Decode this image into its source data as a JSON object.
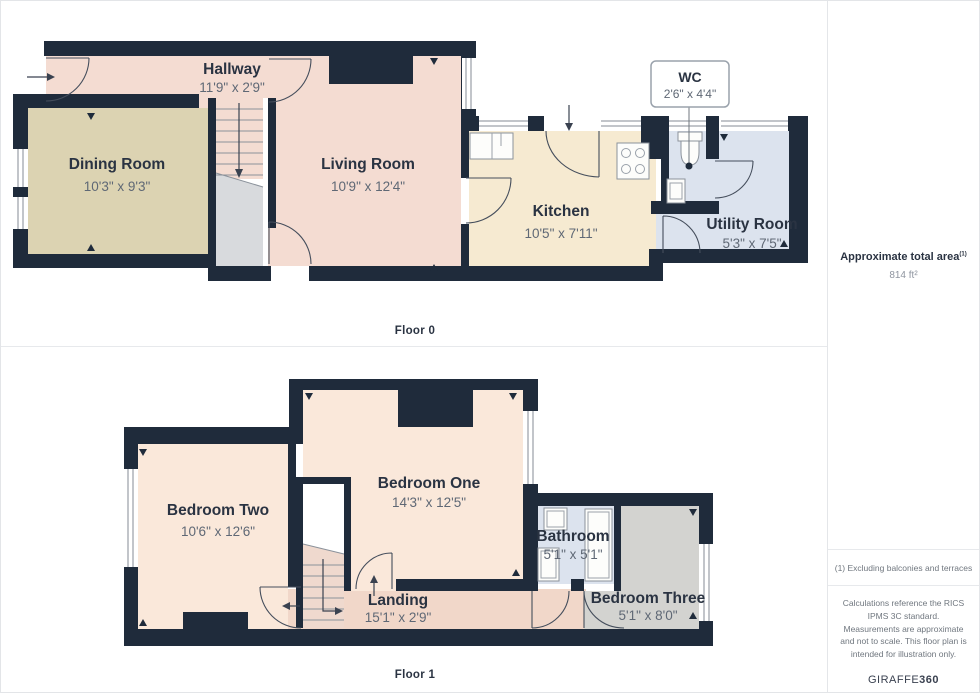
{
  "floors": [
    {
      "label": "Floor 0",
      "rooms": [
        {
          "name": "Hallway",
          "dims": "11'9\" x 2'9\""
        },
        {
          "name": "Dining Room",
          "dims": "10'3\" x 9'3\""
        },
        {
          "name": "Living Room",
          "dims": "10'9\" x 12'4\""
        },
        {
          "name": "Kitchen",
          "dims": "10'5\" x 7'11\""
        },
        {
          "name": "WC",
          "dims": "2'6\" x 4'4\""
        },
        {
          "name": "Utility Room",
          "dims": "5'3\" x 7'5\""
        }
      ]
    },
    {
      "label": "Floor 1",
      "rooms": [
        {
          "name": "Bedroom Two",
          "dims": "10'6\" x 12'6\""
        },
        {
          "name": "Bedroom One",
          "dims": "14'3\" x 12'5\""
        },
        {
          "name": "Landing",
          "dims": "15'1\" x 2'9\""
        },
        {
          "name": "Bathroom",
          "dims": "5'1\" x 5'1\""
        },
        {
          "name": "Bedroom Three",
          "dims": "5'1\" x 8'0\""
        }
      ]
    }
  ],
  "sidebar": {
    "total_area_label": "Approximate total area",
    "total_area_sup": "(1)",
    "total_area_value": "814 ft²",
    "note_exclusion": "(1) Excluding balconies and terraces",
    "note_disclaimer": "Calculations reference the RICS IPMS 3C standard. Measurements are approximate and not to scale. This floor plan is intended for illustration only.",
    "brand_name": "GIRAFFE",
    "brand_bold": "360"
  },
  "colors": {
    "wall": "#1f2b3b",
    "living_pink": "#f4dcd2",
    "bedroom_peach": "#fae8da",
    "landing_pink": "#f1d7c9",
    "dining_tan": "#dcd3b2",
    "kitchen_cream": "#f6ead1",
    "utility_blue": "#dce3ee",
    "bedroom3_gray": "#d3d3d0",
    "understairs_gray": "#d8dadd",
    "label_dark": "#2a3342",
    "label_gray": "#5f6875"
  }
}
